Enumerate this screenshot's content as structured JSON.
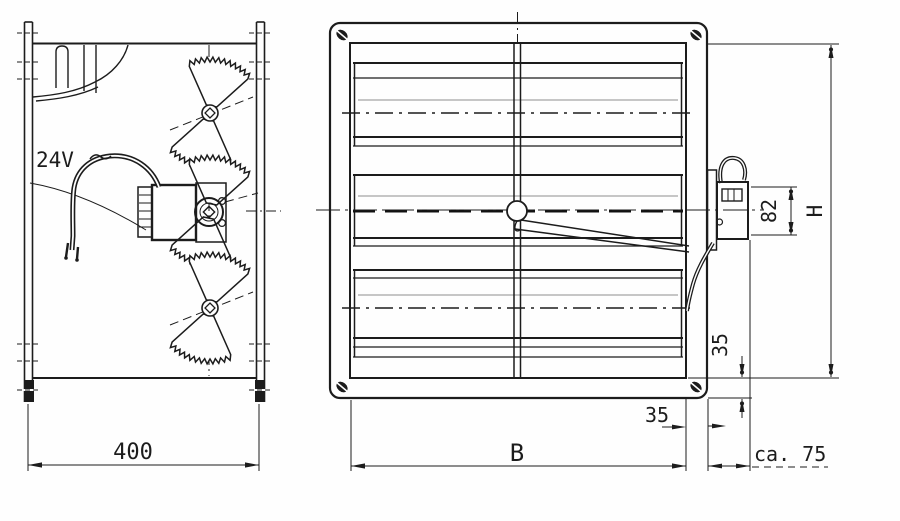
{
  "drawing": {
    "side_view": {
      "voltage_label": "24V",
      "depth_dim": "400"
    },
    "front_view": {
      "width_dim": "B",
      "height_dim": "H",
      "motor_height_dim": "82",
      "frame_face_dim_vertical": "35",
      "frame_face_dim_horizontal": "35",
      "protrusion_dim": "ca. 75"
    },
    "ink_color": "#1c1c1c",
    "paper_color": "#fefefe"
  }
}
